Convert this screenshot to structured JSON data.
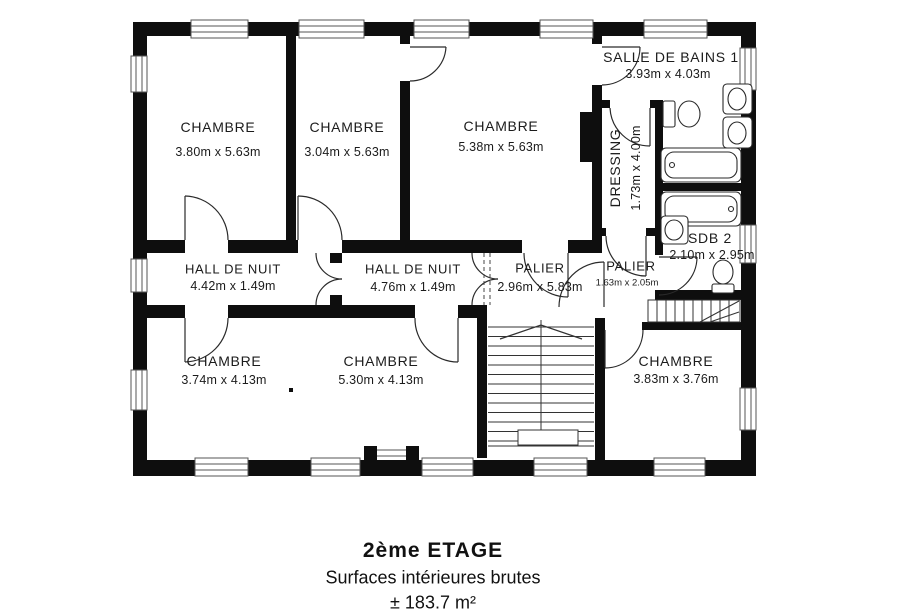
{
  "plan": {
    "rooms": [
      {
        "name": "CHAMBRE",
        "dims": "3.80m x 5.63m"
      },
      {
        "name": "CHAMBRE",
        "dims": "3.04m x 5.63m"
      },
      {
        "name": "CHAMBRE",
        "dims": "5.38m x 5.63m"
      },
      {
        "name": "SALLE DE BAINS 1",
        "dims": "3.93m x 4.03m"
      },
      {
        "name": "DRESSING",
        "dims": "1.73m x 4.00m"
      },
      {
        "name": "SDB 2",
        "dims": "2.10m x 2.95m"
      },
      {
        "name": "HALL DE NUIT",
        "dims": "4.42m x 1.49m"
      },
      {
        "name": "HALL DE NUIT",
        "dims": "4.76m x 1.49m"
      },
      {
        "name": "PALIER",
        "dims": "2.96m x 5.83m"
      },
      {
        "name": "PALIER",
        "dims": "1.63m x 2.05m"
      },
      {
        "name": "CHAMBRE",
        "dims": "3.74m x 4.13m"
      },
      {
        "name": "CHAMBRE",
        "dims": "5.30m x 4.13m"
      },
      {
        "name": "CHAMBRE",
        "dims": "3.83m x 3.76m"
      }
    ]
  },
  "caption": {
    "title": "2ème ETAGE",
    "subtitle": "Surfaces intérieures brutes",
    "area": "± 183.7 m²"
  },
  "colors": {
    "ink": "#0e0e0e",
    "line": "#2a2a2a",
    "paper": "#ffffff"
  }
}
